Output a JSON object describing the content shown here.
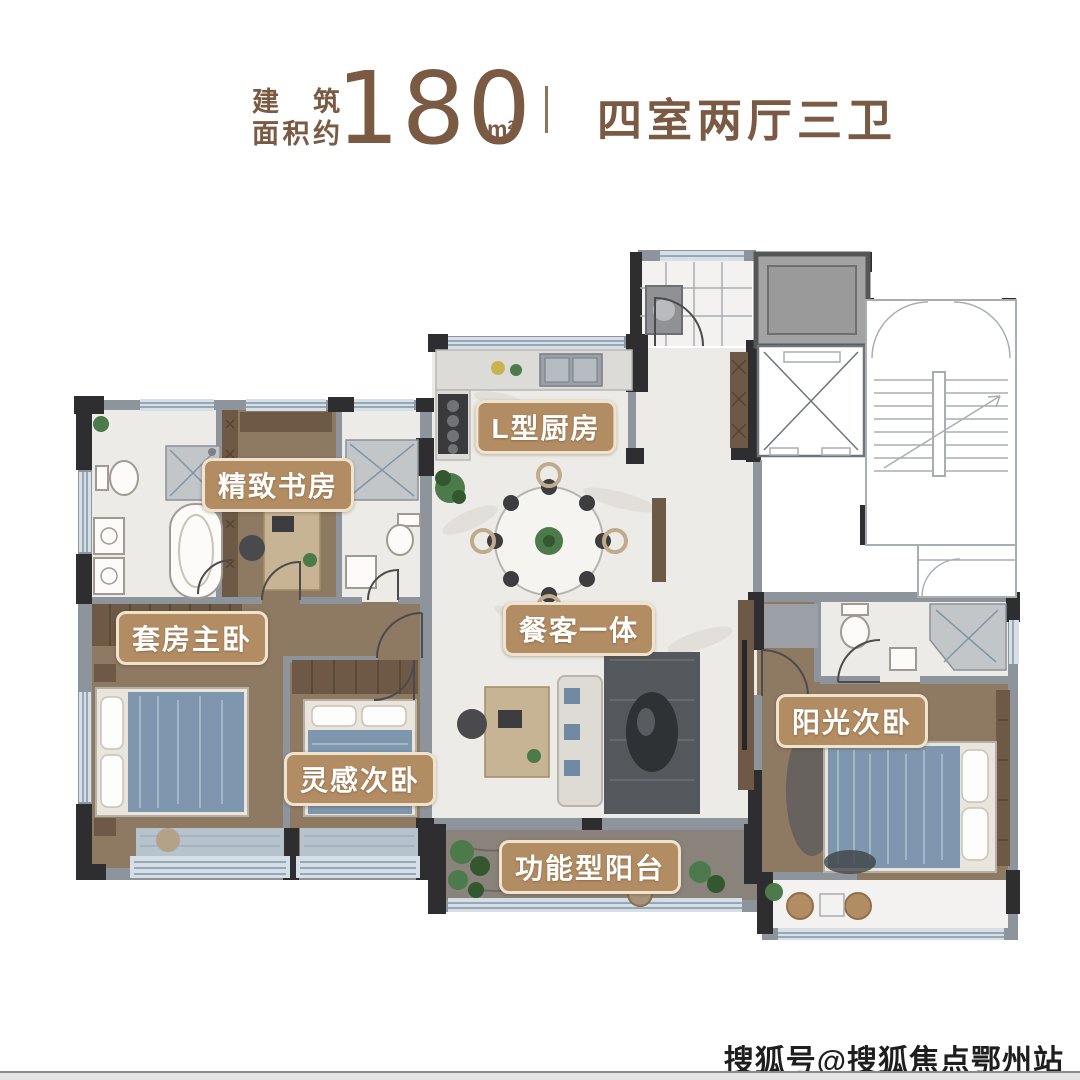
{
  "header": {
    "area_label_line1": "建筑",
    "area_label_line2": "面积约",
    "area_value": "180",
    "area_unit": "m²",
    "layout_text": "四室两厅三卫"
  },
  "rooms": {
    "study": "精致书房",
    "kitchen": "L型厨房",
    "master_suite": "套房主卧",
    "living_dining": "餐客一体",
    "inspiration_bedroom": "灵感次卧",
    "sunny_bedroom": "阳光次卧",
    "functional_balcony": "功能型阳台"
  },
  "watermark": "搜狐号@搜狐焦点鄂州站",
  "colors": {
    "accent_brown": "#7a5a43",
    "label_bg": "#b28c63",
    "label_border": "#f0e3cd",
    "label_text": "#ffffff",
    "wall_dark": "#2e2e30",
    "wall_gray": "#8e949b",
    "wood_floor": "#8e7963",
    "tile_floor": "#edebe7",
    "balcony_floor": "#89837b",
    "bedding_blue": "#7e97ae"
  }
}
